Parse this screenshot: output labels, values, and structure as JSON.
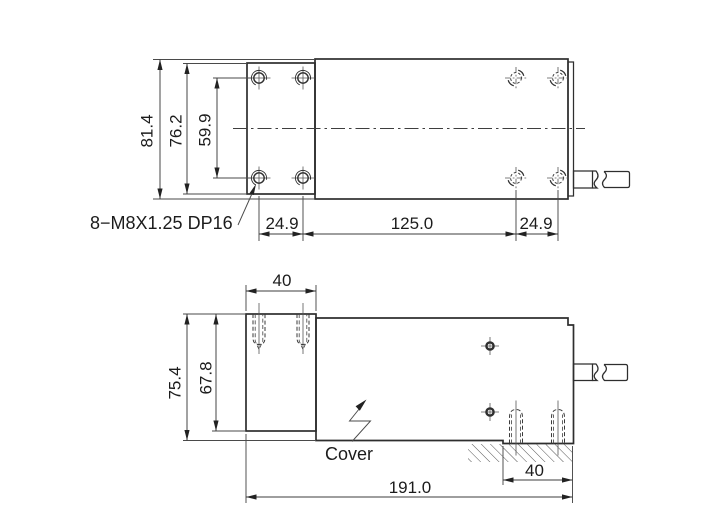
{
  "colors": {
    "line": "#2e2e2e",
    "dim": "#4a4a4a",
    "text": "#1c1c1c",
    "background": "#ffffff"
  },
  "top_view": {
    "dim_height_overall": "81.4",
    "dim_height_plate": "76.2",
    "dim_hole_spacing_vertical": "59.9",
    "thread_note": "8−M8X1.25 DP16",
    "dim_hole_offset_left": "24.9",
    "dim_hole_span": "125.0",
    "dim_hole_offset_right": "24.9"
  },
  "side_view": {
    "dim_plate_width": "40",
    "dim_height_overall": "75.4",
    "dim_height_block": "67.8",
    "cover_label": "Cover",
    "dim_foot_width": "40",
    "dim_length_overall": "191.0"
  }
}
